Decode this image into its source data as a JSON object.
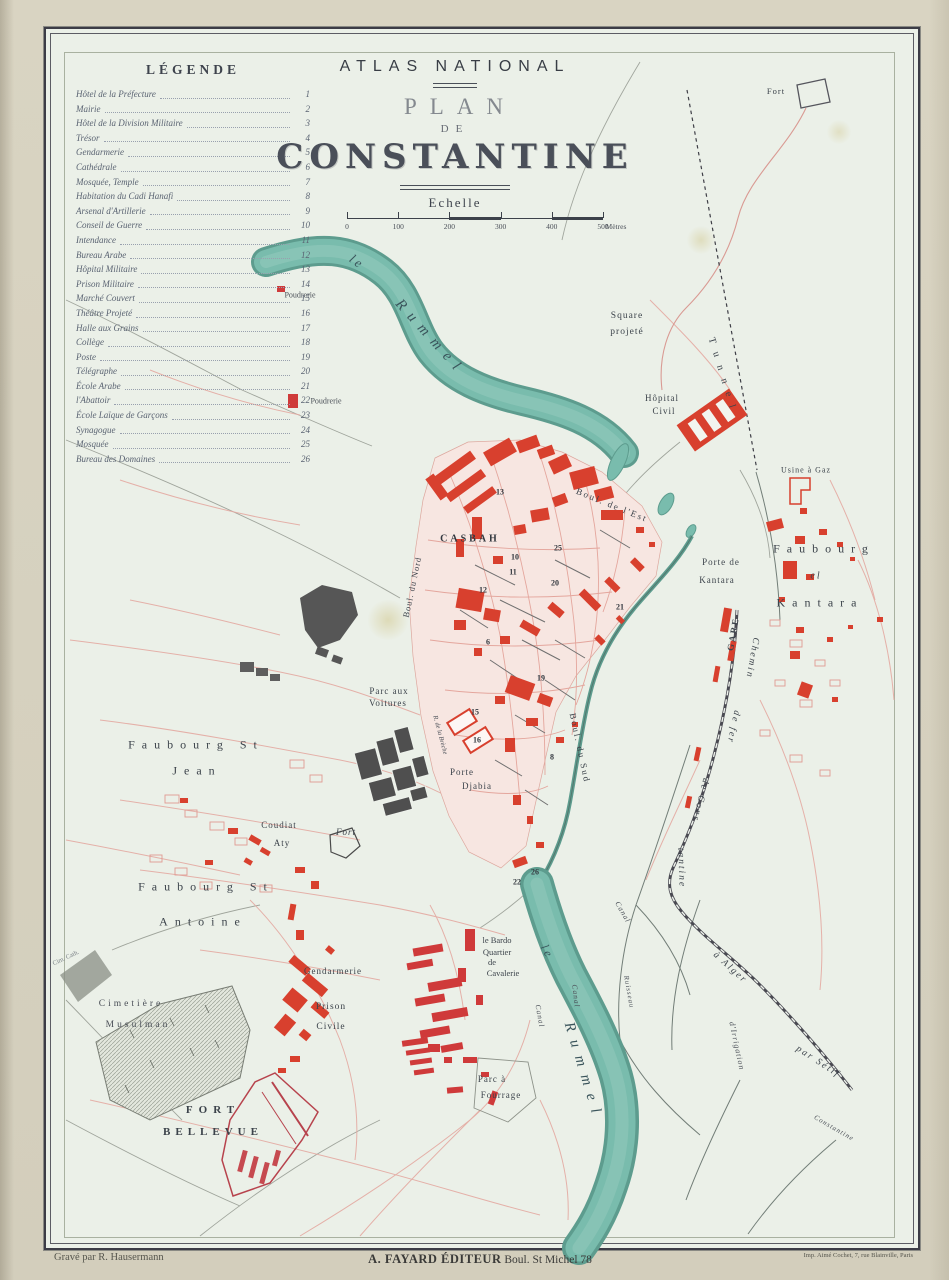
{
  "colors": {
    "paper_margin": "#d8d3c1",
    "sheet": "#ebf0e8",
    "river": "#79bcad",
    "river_edge": "#5d9c8e",
    "building_red": "#d8402e",
    "street_pink": "#e4aaa2",
    "dark_feature": "#4f4f4f",
    "text_dark": "#3c434b",
    "text_river": "#3a545b",
    "text_gray": "#7a8086"
  },
  "legend": {
    "heading": "LÉGENDE",
    "items": [
      {
        "label": "Hôtel de la Préfecture",
        "num": "1"
      },
      {
        "label": "Mairie",
        "num": "2"
      },
      {
        "label": "Hôtel de la Division Militaire",
        "num": "3"
      },
      {
        "label": "Trésor",
        "num": "4"
      },
      {
        "label": "Gendarmerie",
        "num": "5"
      },
      {
        "label": "Cathédrale",
        "num": "6"
      },
      {
        "label": "Mosquée, Temple",
        "num": "7"
      },
      {
        "label": "Habitation du Cadi Hanafi",
        "num": "8"
      },
      {
        "label": "Arsenal d'Artillerie",
        "num": "9"
      },
      {
        "label": "Conseil de Guerre",
        "num": "10"
      },
      {
        "label": "Intendance",
        "num": "11"
      },
      {
        "label": "Bureau Arabe",
        "num": "12"
      },
      {
        "label": "Hôpital Militaire",
        "num": "13"
      },
      {
        "label": "Prison Militaire",
        "num": "14"
      },
      {
        "label": "Marché Couvert",
        "num": "15"
      },
      {
        "label": "Théâtre Projeté",
        "num": "16"
      },
      {
        "label": "Halle aux Grains",
        "num": "17"
      },
      {
        "label": "Collège",
        "num": "18"
      },
      {
        "label": "Poste",
        "num": "19"
      },
      {
        "label": "Télégraphe",
        "num": "20"
      },
      {
        "label": "École Arabe",
        "num": "21"
      },
      {
        "label": "l'Abattoir",
        "num": "22"
      },
      {
        "label": "École Laïque de Garçons",
        "num": "23"
      },
      {
        "label": "Synagogue",
        "num": "24"
      },
      {
        "label": "Mosquée",
        "num": "25"
      },
      {
        "label": "Bureau des Domaines",
        "num": "26"
      }
    ]
  },
  "title_block": {
    "series": "ATLAS NATIONAL",
    "line1": "PLAN",
    "line2": "DE",
    "line3": "CONSTANTINE"
  },
  "scale": {
    "label": "Echelle",
    "ticks": [
      "0",
      "100",
      "200",
      "300",
      "400",
      "500"
    ],
    "unit": "Mètres"
  },
  "imprint": {
    "left": "Gravé par R. Hausermann",
    "center_bold": "A. FAYARD ÉDITEUR",
    "center_rest": " Boul. St Michel 78",
    "right": "Imp. Aimé Cochet, 7, rue Blainville, Paris"
  },
  "map": {
    "labels": [
      {
        "n": "river-le-upper",
        "t": "le",
        "x": 357,
        "y": 262,
        "s": 13,
        "r": 36,
        "ls": 3,
        "c": "#3a545b",
        "i": true
      },
      {
        "n": "river-rummel-upper",
        "t": "Rummel",
        "x": 430,
        "y": 338,
        "s": 15,
        "r": 48,
        "ls": 8,
        "c": "#3a545b",
        "i": true
      },
      {
        "n": "river-le-lower",
        "t": "le",
        "x": 547,
        "y": 952,
        "s": 12,
        "r": 62,
        "ls": 3,
        "c": "#3a545b",
        "i": true
      },
      {
        "n": "river-rummel-lower",
        "t": "Rummel",
        "x": 583,
        "y": 1072,
        "s": 15,
        "r": 73,
        "ls": 9,
        "c": "#3a545b",
        "i": true
      },
      {
        "n": "poudrerie-1",
        "t": "Poudrerie",
        "x": 300,
        "y": 295,
        "s": 8,
        "r": 0,
        "ls": 0,
        "c": "#4a4f57"
      },
      {
        "n": "poudrerie-2",
        "t": "Poudrerie",
        "x": 326,
        "y": 401,
        "s": 8,
        "r": 0,
        "ls": 0,
        "c": "#4a4f57"
      },
      {
        "n": "square-projete-1",
        "t": "Square",
        "x": 627,
        "y": 316,
        "s": 9.5,
        "r": 0,
        "ls": 1,
        "c": "#3c434b"
      },
      {
        "n": "square-projete-2",
        "t": "projeté",
        "x": 627,
        "y": 332,
        "s": 9.5,
        "r": 0,
        "ls": 1,
        "c": "#3c434b"
      },
      {
        "n": "fort-top",
        "t": "Fort",
        "x": 776,
        "y": 91,
        "s": 8.5,
        "r": 0,
        "ls": 1,
        "c": "#3c434b"
      },
      {
        "n": "tunnel",
        "t": "Tunnel",
        "x": 723,
        "y": 377,
        "s": 10,
        "r": 73,
        "ls": 9,
        "c": "#3c434b"
      },
      {
        "n": "hopital-civil-1",
        "t": "Hôpital",
        "x": 662,
        "y": 398,
        "s": 9,
        "r": 0,
        "ls": 1,
        "c": "#3c434b"
      },
      {
        "n": "hopital-civil-2",
        "t": "Civil",
        "x": 664,
        "y": 411,
        "s": 9,
        "r": 0,
        "ls": 1,
        "c": "#3c434b"
      },
      {
        "n": "usine-a-gaz",
        "t": "Usine à Gaz",
        "x": 806,
        "y": 470,
        "s": 8,
        "r": 0,
        "ls": 1,
        "c": "#3c434b"
      },
      {
        "n": "faubourg-kantara-1",
        "t": "Faubourg",
        "x": 824,
        "y": 549,
        "s": 12,
        "r": 0,
        "ls": 7,
        "c": "#3c434b"
      },
      {
        "n": "faubourg-kantara-2",
        "t": "el",
        "x": 816,
        "y": 576,
        "s": 10,
        "r": 0,
        "ls": 2,
        "c": "#3c434b",
        "i": true
      },
      {
        "n": "faubourg-kantara-3",
        "t": "Kantara",
        "x": 820,
        "y": 603,
        "s": 12,
        "r": 0,
        "ls": 7,
        "c": "#3c434b"
      },
      {
        "n": "porte-de-kantara-1",
        "t": "Porte de",
        "x": 721,
        "y": 562,
        "s": 9,
        "r": 0,
        "ls": 1,
        "c": "#3c434b"
      },
      {
        "n": "porte-de-kantara-2",
        "t": "Kantara",
        "x": 717,
        "y": 580,
        "s": 9,
        "r": 0,
        "ls": 1,
        "c": "#3c434b"
      },
      {
        "n": "gare",
        "t": "GARE",
        "x": 733,
        "y": 634,
        "s": 9,
        "r": -80,
        "ls": 2,
        "c": "#3c434b",
        "w": 600
      },
      {
        "n": "railway-label-1",
        "t": "Chemin",
        "x": 752,
        "y": 658,
        "s": 9.5,
        "r": 100,
        "ls": 2,
        "c": "#3c434b",
        "i": true
      },
      {
        "n": "railway-label-2",
        "t": "de fer",
        "x": 733,
        "y": 727,
        "s": 9.5,
        "r": 102,
        "ls": 2,
        "c": "#3c434b",
        "i": true
      },
      {
        "n": "railway-label-3",
        "t": "de Cons",
        "x": 700,
        "y": 800,
        "s": 9.5,
        "r": 104,
        "ls": 2,
        "c": "#3c434b",
        "i": true
      },
      {
        "n": "railway-label-4",
        "t": "tantine",
        "x": 681,
        "y": 868,
        "s": 9.5,
        "r": 88,
        "ls": 2,
        "c": "#3c434b",
        "i": true
      },
      {
        "n": "railway-label-5",
        "t": "à Alger",
        "x": 730,
        "y": 968,
        "s": 9.5,
        "r": 42,
        "ls": 2,
        "c": "#3c434b",
        "i": true
      },
      {
        "n": "railway-label-6",
        "t": "par Sétif",
        "x": 818,
        "y": 1062,
        "s": 9.5,
        "r": 33,
        "ls": 2,
        "c": "#3c434b",
        "i": true
      },
      {
        "n": "casbah",
        "t": "CASBAH",
        "x": 470,
        "y": 539,
        "s": 10,
        "r": 0,
        "ls": 3,
        "c": "#33383f",
        "w": 600
      },
      {
        "n": "boulevard-est",
        "t": "Boul. de l'Est",
        "x": 612,
        "y": 505,
        "s": 9,
        "r": 22,
        "ls": 2,
        "c": "#3c434b"
      },
      {
        "n": "boulevard-sud",
        "t": "Boul. du Sud",
        "x": 580,
        "y": 748,
        "s": 9,
        "r": 78,
        "ls": 2,
        "c": "#3c434b"
      },
      {
        "n": "boulevard-nord",
        "t": "Boul. du Nord",
        "x": 412,
        "y": 587,
        "s": 8.5,
        "r": -78,
        "ls": 1,
        "c": "#3c434b"
      },
      {
        "n": "parc-aux-voitures-1",
        "t": "Parc aux",
        "x": 389,
        "y": 691,
        "s": 9,
        "r": 0,
        "ls": 1,
        "c": "#3c434b"
      },
      {
        "n": "parc-aux-voitures-2",
        "t": "Voitures",
        "x": 388,
        "y": 703,
        "s": 9,
        "r": 0,
        "ls": 1,
        "c": "#3c434b"
      },
      {
        "n": "porte-djabia-1",
        "t": "Porte",
        "x": 462,
        "y": 772,
        "s": 9,
        "r": 0,
        "ls": 1,
        "c": "#3c434b"
      },
      {
        "n": "porte-djabia-2",
        "t": "Djabia",
        "x": 477,
        "y": 786,
        "s": 9,
        "r": 0,
        "ls": 1,
        "c": "#3c434b"
      },
      {
        "n": "faubourg-st-jean-1",
        "t": "Faubourg St",
        "x": 196,
        "y": 745,
        "s": 12,
        "r": 0,
        "ls": 7,
        "c": "#3c434b"
      },
      {
        "n": "faubourg-st-jean-2",
        "t": "Jean",
        "x": 197,
        "y": 771,
        "s": 12,
        "r": 0,
        "ls": 7,
        "c": "#3c434b"
      },
      {
        "n": "coudiat-aty-1",
        "t": "Coudiat",
        "x": 279,
        "y": 825,
        "s": 9,
        "r": 0,
        "ls": 1,
        "c": "#3c434b"
      },
      {
        "n": "coudiat-aty-2",
        "t": "Aty",
        "x": 282,
        "y": 843,
        "s": 9,
        "r": 0,
        "ls": 1,
        "c": "#3c434b"
      },
      {
        "n": "fort-coudiat",
        "t": "Fort",
        "x": 346,
        "y": 832,
        "s": 9,
        "r": 0,
        "ls": 1,
        "c": "#3c434b",
        "i": true
      },
      {
        "n": "faubourg-st-antoine-1",
        "t": "Faubourg St",
        "x": 206,
        "y": 887,
        "s": 12,
        "r": 0,
        "ls": 7,
        "c": "#3c434b"
      },
      {
        "n": "faubourg-st-antoine-2",
        "t": "Antoine",
        "x": 203,
        "y": 922,
        "s": 12,
        "r": 0,
        "ls": 7,
        "c": "#3c434b"
      },
      {
        "n": "cimetiere-musulman-1",
        "t": "Cimetière",
        "x": 131,
        "y": 1004,
        "s": 9.5,
        "r": 0,
        "ls": 3,
        "c": "#4a4f57"
      },
      {
        "n": "cimetiere-musulman-2",
        "t": "Musulman",
        "x": 138,
        "y": 1025,
        "s": 9.5,
        "r": 0,
        "ls": 3,
        "c": "#4a4f57"
      },
      {
        "n": "cimetiere-catholique",
        "t": "Cim. Cath.",
        "x": 66,
        "y": 958,
        "s": 6.5,
        "r": -25,
        "ls": 0,
        "c": "#7a8086"
      },
      {
        "n": "fort-bellevue-1",
        "t": "FORT",
        "x": 213,
        "y": 1110,
        "s": 11,
        "r": 0,
        "ls": 6,
        "c": "#3c434b",
        "w": 600
      },
      {
        "n": "fort-bellevue-2",
        "t": "BELLEVUE",
        "x": 213,
        "y": 1132,
        "s": 11,
        "r": 0,
        "ls": 5,
        "c": "#3c434b",
        "w": 600
      },
      {
        "n": "gendarmerie",
        "t": "Gendarmerie",
        "x": 333,
        "y": 971,
        "s": 9,
        "r": 0,
        "ls": 1,
        "c": "#3c434b"
      },
      {
        "n": "prison-civile-1",
        "t": "Prison",
        "x": 331,
        "y": 1007,
        "s": 9.5,
        "r": 0,
        "ls": 1,
        "c": "#3c434b"
      },
      {
        "n": "prison-civile-2",
        "t": "Civile",
        "x": 331,
        "y": 1027,
        "s": 9.5,
        "r": 0,
        "ls": 1,
        "c": "#3c434b"
      },
      {
        "n": "le-bardo-1",
        "t": "le Bardo",
        "x": 497,
        "y": 940,
        "s": 8.5,
        "r": 0,
        "ls": 0,
        "c": "#3c434b"
      },
      {
        "n": "le-bardo-2",
        "t": "Quartier",
        "x": 497,
        "y": 952,
        "s": 8.5,
        "r": 0,
        "ls": 0,
        "c": "#3c434b"
      },
      {
        "n": "le-bardo-3",
        "t": "de",
        "x": 492,
        "y": 962,
        "s": 8.5,
        "r": 0,
        "ls": 0,
        "c": "#3c434b"
      },
      {
        "n": "le-bardo-4",
        "t": "Cavalerie",
        "x": 503,
        "y": 973,
        "s": 8.5,
        "r": 0,
        "ls": 0,
        "c": "#3c434b"
      },
      {
        "n": "parc-a-fourrage-1",
        "t": "Parc à",
        "x": 492,
        "y": 1079,
        "s": 9,
        "r": 0,
        "ls": 1,
        "c": "#3c434b"
      },
      {
        "n": "parc-a-fourrage-2",
        "t": "Fourrage",
        "x": 501,
        "y": 1095,
        "s": 9,
        "r": 0,
        "ls": 1,
        "c": "#3c434b"
      },
      {
        "n": "canal-1",
        "t": "Canal",
        "x": 623,
        "y": 912,
        "s": 7.5,
        "r": 60,
        "ls": 1,
        "c": "#4a4f57",
        "i": true
      },
      {
        "n": "canal-2",
        "t": "Canal",
        "x": 576,
        "y": 996,
        "s": 7.5,
        "r": 83,
        "ls": 1,
        "c": "#4a4f57",
        "i": true
      },
      {
        "n": "canal-3",
        "t": "Canal",
        "x": 540,
        "y": 1016,
        "s": 7.5,
        "r": 80,
        "ls": 1,
        "c": "#4a4f57",
        "i": true
      },
      {
        "n": "ruisseau",
        "t": "Ruisseau",
        "x": 629,
        "y": 992,
        "s": 7,
        "r": 80,
        "ls": 1,
        "c": "#4a4f57",
        "i": true
      },
      {
        "n": "canal-irrigation",
        "t": "d'Irrigation",
        "x": 737,
        "y": 1046,
        "s": 8,
        "r": 78,
        "ls": 1,
        "c": "#4a4f57",
        "i": true
      },
      {
        "n": "route-constantine",
        "t": "Constantine",
        "x": 834,
        "y": 1128,
        "s": 7,
        "r": 30,
        "ls": 1,
        "c": "#4a4f57",
        "i": true
      },
      {
        "n": "rue-de-la-breche",
        "t": "R. de la Brèche",
        "x": 440,
        "y": 735,
        "s": 6.5,
        "r": 75,
        "ls": 0,
        "c": "#4a4f57",
        "i": true
      },
      {
        "n": "ref-13",
        "t": "13",
        "x": 500,
        "y": 492,
        "s": 8,
        "r": 0,
        "ls": 0,
        "c": "#33383f",
        "w": 600
      },
      {
        "n": "ref-10",
        "t": "10",
        "x": 515,
        "y": 557,
        "s": 8,
        "r": 0,
        "ls": 0,
        "c": "#33383f",
        "w": 600
      },
      {
        "n": "ref-11",
        "t": "11",
        "x": 513,
        "y": 572,
        "s": 8,
        "r": 0,
        "ls": 0,
        "c": "#33383f",
        "w": 600
      },
      {
        "n": "ref-12",
        "t": "12",
        "x": 483,
        "y": 590,
        "s": 8,
        "r": 0,
        "ls": 0,
        "c": "#33383f",
        "w": 600
      },
      {
        "n": "ref-25",
        "t": "25",
        "x": 558,
        "y": 548,
        "s": 8,
        "r": 0,
        "ls": 0,
        "c": "#33383f",
        "w": 600
      },
      {
        "n": "ref-20",
        "t": "20",
        "x": 555,
        "y": 583,
        "s": 8,
        "r": 0,
        "ls": 0,
        "c": "#33383f",
        "w": 600
      },
      {
        "n": "ref-21",
        "t": "21",
        "x": 620,
        "y": 607,
        "s": 8,
        "r": 0,
        "ls": 0,
        "c": "#33383f",
        "w": 600
      },
      {
        "n": "ref-19",
        "t": "19",
        "x": 541,
        "y": 678,
        "s": 8,
        "r": 0,
        "ls": 0,
        "c": "#33383f",
        "w": 600
      },
      {
        "n": "ref-6",
        "t": "6",
        "x": 488,
        "y": 642,
        "s": 8,
        "r": 0,
        "ls": 0,
        "c": "#33383f",
        "w": 600
      },
      {
        "n": "ref-15",
        "t": "15",
        "x": 475,
        "y": 712,
        "s": 8,
        "r": 0,
        "ls": 0,
        "c": "#33383f",
        "w": 600
      },
      {
        "n": "ref-16",
        "t": "16",
        "x": 477,
        "y": 740,
        "s": 8,
        "r": 0,
        "ls": 0,
        "c": "#33383f",
        "w": 600
      },
      {
        "n": "ref-8",
        "t": "8",
        "x": 552,
        "y": 757,
        "s": 8,
        "r": 0,
        "ls": 0,
        "c": "#33383f",
        "w": 600
      },
      {
        "n": "ref-26",
        "t": "26",
        "x": 535,
        "y": 872,
        "s": 8,
        "r": 0,
        "ls": 0,
        "c": "#33383f",
        "w": 600
      },
      {
        "n": "ref-22",
        "t": "22",
        "x": 517,
        "y": 882,
        "s": 8,
        "r": 0,
        "ls": 0,
        "c": "#33383f",
        "w": 600
      }
    ]
  }
}
